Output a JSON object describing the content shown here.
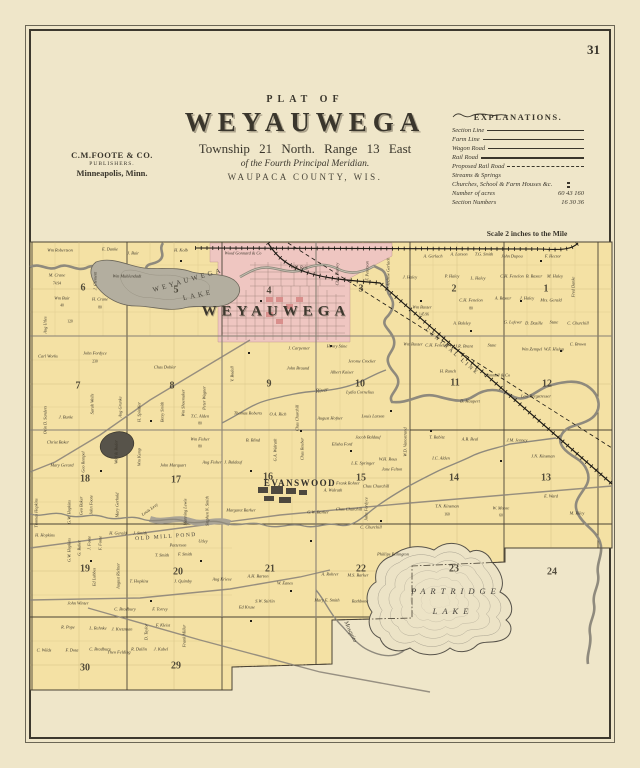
{
  "page": {
    "number": "31"
  },
  "publisher": {
    "line1": "C.M.FOOTE & CO.",
    "line2": "PUBLISHERS.",
    "line3": "Minneapolis, Minn."
  },
  "title": {
    "plat_of": "PLAT OF",
    "name": "WEYAUWEGA",
    "township": "Township  21  North.  Range  13  East",
    "meridian": "of the Fourth Principal Meridian.",
    "county": "WAUPACA COUNTY, WIS."
  },
  "legend": {
    "title": "EXPLANATIONS.",
    "rows": [
      {
        "label": "Section Line",
        "symbol": "solid-thin"
      },
      {
        "label": "Farm Line",
        "symbol": "solid-thin"
      },
      {
        "label": "Wagon Road",
        "symbol": "solid-medium"
      },
      {
        "label": "Rail Road",
        "symbol": "railroad"
      },
      {
        "label": "Proposed Rail Road",
        "symbol": "dashed"
      },
      {
        "label": "Streams & Springs",
        "symbol": "stream"
      },
      {
        "label": "Churches, School & Farm Houses &c.",
        "symbol": "dots"
      },
      {
        "label": "Number of acres",
        "symbol": "text",
        "value": "60  43  160"
      },
      {
        "label": "Section Numbers",
        "symbol": "text",
        "value": "16  30  36"
      }
    ]
  },
  "scale": {
    "text": "Scale 2 inches to the Mile"
  },
  "map": {
    "colors": {
      "parcel": "#f4e1a4",
      "village": "#efc6c1",
      "water": "#b3ae9f",
      "line": "#4a4335",
      "cream": "#efe6c9"
    },
    "place_labels": [
      {
        "t": "WEYAUWEGA",
        "x": 276,
        "y": 312,
        "cls": "village-name"
      },
      {
        "t": "WEYAUWEGA",
        "x": 188,
        "y": 280,
        "cls": "lake-name",
        "r": -16
      },
      {
        "t": "LAKE",
        "x": 198,
        "y": 295,
        "cls": "lake-name",
        "r": -12
      },
      {
        "t": "EVANSWOOD",
        "x": 300,
        "y": 483,
        "cls": "town-name"
      },
      {
        "t": "PARTRIDGE",
        "x": 456,
        "y": 591,
        "cls": "lake-name2"
      },
      {
        "t": "LAKE",
        "x": 453,
        "y": 611,
        "cls": "lake-name2"
      },
      {
        "t": "OLD MILL POND",
        "x": 166,
        "y": 537,
        "cls": "pond-name",
        "r": -4
      },
      {
        "t": "CENTRAL LINE",
        "x": 452,
        "y": 352,
        "cls": "rr-name",
        "r": 41
      },
      {
        "t": "Mosquito",
        "x": 350,
        "y": 632,
        "cls": "creek-name",
        "r": 65
      },
      {
        "t": "River",
        "x": 322,
        "y": 391,
        "cls": "creek-name",
        "r": -8
      }
    ],
    "section_numbers": [
      {
        "t": "1",
        "x": 546,
        "y": 289
      },
      {
        "t": "2",
        "x": 454,
        "y": 289
      },
      {
        "t": "3",
        "x": 361,
        "y": 289
      },
      {
        "t": "4",
        "x": 269,
        "y": 291
      },
      {
        "t": "5",
        "x": 176,
        "y": 290
      },
      {
        "t": "6",
        "x": 83,
        "y": 288
      },
      {
        "t": "7",
        "x": 78,
        "y": 386
      },
      {
        "t": "8",
        "x": 172,
        "y": 386
      },
      {
        "t": "9",
        "x": 269,
        "y": 384
      },
      {
        "t": "10",
        "x": 360,
        "y": 384
      },
      {
        "t": "11",
        "x": 455,
        "y": 383
      },
      {
        "t": "12",
        "x": 547,
        "y": 384
      },
      {
        "t": "13",
        "x": 546,
        "y": 478
      },
      {
        "t": "14",
        "x": 454,
        "y": 478
      },
      {
        "t": "15",
        "x": 361,
        "y": 478
      },
      {
        "t": "16",
        "x": 268,
        "y": 477
      },
      {
        "t": "17",
        "x": 176,
        "y": 480
      },
      {
        "t": "18",
        "x": 85,
        "y": 479
      },
      {
        "t": "19",
        "x": 85,
        "y": 569
      },
      {
        "t": "20",
        "x": 178,
        "y": 572
      },
      {
        "t": "21",
        "x": 270,
        "y": 569
      },
      {
        "t": "22",
        "x": 361,
        "y": 569
      },
      {
        "t": "23",
        "x": 454,
        "y": 569
      },
      {
        "t": "24",
        "x": 552,
        "y": 572
      },
      {
        "t": "29",
        "x": 176,
        "y": 666
      },
      {
        "t": "30",
        "x": 85,
        "y": 668
      }
    ],
    "owners": [
      {
        "t": "Wm Robertson",
        "x": 60,
        "y": 251
      },
      {
        "t": "M. Crane",
        "x": 57,
        "y": 276
      },
      {
        "t": "74.94",
        "x": 57,
        "y": 284,
        "cls": "acre",
        "s": 0.6
      },
      {
        "t": "Wm Bair",
        "x": 62,
        "y": 299
      },
      {
        "t": "40",
        "x": 62,
        "y": 306,
        "cls": "acre",
        "s": 0.6
      },
      {
        "t": "H. Crane",
        "x": 100,
        "y": 300
      },
      {
        "t": "80",
        "x": 100,
        "y": 308,
        "cls": "acre",
        "s": 0.6
      },
      {
        "t": "Aug Utles",
        "x": 46,
        "y": 325,
        "r": -90
      },
      {
        "t": "120",
        "x": 70,
        "y": 322,
        "cls": "acre",
        "s": 0.6
      },
      {
        "t": "John Fordyce",
        "x": 95,
        "y": 354
      },
      {
        "t": "230",
        "x": 95,
        "y": 362,
        "cls": "acre",
        "s": 0.6
      },
      {
        "t": "Carl Works",
        "x": 48,
        "y": 357
      },
      {
        "t": "J. Clement",
        "x": 96,
        "y": 281,
        "r": -90
      },
      {
        "t": "Wm Muhlendadt",
        "x": 127,
        "y": 277
      },
      {
        "t": "J. Bair",
        "x": 133,
        "y": 254
      },
      {
        "t": "H. Kolb",
        "x": 181,
        "y": 251
      },
      {
        "t": "E. Danke",
        "x": 110,
        "y": 250
      },
      {
        "t": "Wood Gonnard & Co",
        "x": 243,
        "y": 254
      },
      {
        "t": "W.H. Reis",
        "x": 299,
        "y": 268
      },
      {
        "t": "Chas Harvey",
        "x": 338,
        "y": 274,
        "r": -90
      },
      {
        "t": "F. Peterson",
        "x": 368,
        "y": 271,
        "r": -90
      },
      {
        "t": "Andrew Gerlach",
        "x": 389,
        "y": 272,
        "r": -90
      },
      {
        "t": "A. Gerlach",
        "x": 433,
        "y": 257
      },
      {
        "t": "A. Larson",
        "x": 459,
        "y": 255
      },
      {
        "t": "T.G. Smith",
        "x": 484,
        "y": 255
      },
      {
        "t": "John Dupou",
        "x": 512,
        "y": 257
      },
      {
        "t": "F. Hector",
        "x": 553,
        "y": 257
      },
      {
        "t": "Fred Danke",
        "x": 574,
        "y": 287,
        "r": -90
      },
      {
        "t": "J. Haley",
        "x": 410,
        "y": 278
      },
      {
        "t": "P. Haley",
        "x": 452,
        "y": 277
      },
      {
        "t": "L. Haley",
        "x": 478,
        "y": 279
      },
      {
        "t": "C.H. Fenelon",
        "x": 512,
        "y": 277
      },
      {
        "t": "B. Baxter",
        "x": 534,
        "y": 277
      },
      {
        "t": "M. Haley",
        "x": 555,
        "y": 277
      },
      {
        "t": "Wm Baxter",
        "x": 422,
        "y": 308
      },
      {
        "t": "145.96",
        "x": 424,
        "y": 315,
        "cls": "acre",
        "s": 0.6
      },
      {
        "t": "C.H. Fenelon",
        "x": 471,
        "y": 301
      },
      {
        "t": "80",
        "x": 471,
        "y": 309,
        "cls": "acre",
        "s": 0.6
      },
      {
        "t": "A. Baxter",
        "x": 503,
        "y": 299
      },
      {
        "t": "J. Haley",
        "x": 527,
        "y": 299
      },
      {
        "t": "Mrs. Gerald",
        "x": 551,
        "y": 301
      },
      {
        "t": "A. Balsley",
        "x": 462,
        "y": 324
      },
      {
        "t": "G. Lefever",
        "x": 513,
        "y": 323
      },
      {
        "t": "D. Dazille",
        "x": 534,
        "y": 324
      },
      {
        "t": "State",
        "x": 554,
        "y": 323
      },
      {
        "t": "C. Churchill",
        "x": 578,
        "y": 324
      },
      {
        "t": "Wm Baxter",
        "x": 413,
        "y": 345
      },
      {
        "t": "C.H. Fenelon",
        "x": 437,
        "y": 346
      },
      {
        "t": "J.R. Brant",
        "x": 464,
        "y": 347
      },
      {
        "t": "State",
        "x": 492,
        "y": 346
      },
      {
        "t": "Wm Zempel",
        "x": 532,
        "y": 350
      },
      {
        "t": "W.F. Hislop",
        "x": 554,
        "y": 350
      },
      {
        "t": "C. Brown",
        "x": 578,
        "y": 345
      },
      {
        "t": "Henry Stine",
        "x": 337,
        "y": 347
      },
      {
        "t": "J. Carpenter",
        "x": 299,
        "y": 349
      },
      {
        "t": "Jerome Crocker",
        "x": 362,
        "y": 362
      },
      {
        "t": "Albert Kaiser",
        "x": 342,
        "y": 373
      },
      {
        "t": "H. Ranch",
        "x": 448,
        "y": 372
      },
      {
        "t": "Gammell & Co",
        "x": 497,
        "y": 376
      },
      {
        "t": "Levi Bergstresser",
        "x": 536,
        "y": 397
      },
      {
        "t": "D. Haupert",
        "x": 470,
        "y": 402
      },
      {
        "t": "A.B. Beal",
        "x": 470,
        "y": 440
      },
      {
        "t": "J.M. Jenney",
        "x": 517,
        "y": 441
      },
      {
        "t": "T. Babitz",
        "x": 437,
        "y": 438
      },
      {
        "t": "I.C. Alden",
        "x": 441,
        "y": 459
      },
      {
        "t": "W.D. Vanostrand",
        "x": 406,
        "y": 442,
        "r": -90
      },
      {
        "t": "J.N. Kinsman",
        "x": 543,
        "y": 457
      },
      {
        "t": "M. Riley",
        "x": 577,
        "y": 514
      },
      {
        "t": "E. Ward",
        "x": 551,
        "y": 497
      },
      {
        "t": "W. Moore",
        "x": 501,
        "y": 509
      },
      {
        "t": "60",
        "x": 501,
        "y": 516,
        "cls": "acre",
        "s": 0.6
      },
      {
        "t": "Chas Dobler",
        "x": 165,
        "y": 368
      },
      {
        "t": "Orin D. Sanders",
        "x": 46,
        "y": 420,
        "r": -90
      },
      {
        "t": "Sarah Wells",
        "x": 93,
        "y": 404,
        "r": -90
      },
      {
        "t": "Aug Grunke",
        "x": 121,
        "y": 407,
        "r": -90
      },
      {
        "t": "H. Spindler",
        "x": 140,
        "y": 412,
        "r": -90
      },
      {
        "t": "Betsy Smith",
        "x": 163,
        "y": 412,
        "r": -90
      },
      {
        "t": "Wm Shoemaker",
        "x": 184,
        "y": 403,
        "r": -90
      },
      {
        "t": "Peter Wagner",
        "x": 205,
        "y": 398,
        "r": -90
      },
      {
        "t": "T.C. Alden",
        "x": 200,
        "y": 417
      },
      {
        "t": "80",
        "x": 200,
        "y": 424,
        "cls": "acre",
        "s": 0.6
      },
      {
        "t": "Wm Fisher",
        "x": 200,
        "y": 440
      },
      {
        "t": "80",
        "x": 200,
        "y": 447,
        "cls": "acre",
        "s": 0.6
      },
      {
        "t": "Christ Baker",
        "x": 58,
        "y": 443
      },
      {
        "t": "Mary Gerard",
        "x": 62,
        "y": 466
      },
      {
        "t": "J. Burke",
        "x": 66,
        "y": 418
      },
      {
        "t": "Geo Rempel",
        "x": 84,
        "y": 462,
        "r": -90
      },
      {
        "t": "Wolf & Bader",
        "x": 117,
        "y": 452,
        "r": -90
      },
      {
        "t": "Wm Kemp",
        "x": 140,
        "y": 457,
        "r": -90
      },
      {
        "t": "John Marquart",
        "x": 173,
        "y": 466
      },
      {
        "t": "Aug Fisher",
        "x": 212,
        "y": 463
      },
      {
        "t": "V. Bodell",
        "x": 233,
        "y": 374,
        "r": -90
      },
      {
        "t": "John Braund",
        "x": 298,
        "y": 369
      },
      {
        "t": "Thomas Roberts",
        "x": 248,
        "y": 414
      },
      {
        "t": "O.A. Rich",
        "x": 278,
        "y": 415
      },
      {
        "t": "Chas Churchill",
        "x": 298,
        "y": 418,
        "r": -90
      },
      {
        "t": "August Hofner",
        "x": 330,
        "y": 419
      },
      {
        "t": "Louis Larson",
        "x": 373,
        "y": 417
      },
      {
        "t": "Lydia Cornelius",
        "x": 360,
        "y": 393
      },
      {
        "t": "B. Blind",
        "x": 253,
        "y": 441
      },
      {
        "t": "J. Baldauf",
        "x": 233,
        "y": 463
      },
      {
        "t": "Elisha Ford",
        "x": 342,
        "y": 445
      },
      {
        "t": "Jacob Baldauf",
        "x": 368,
        "y": 438
      },
      {
        "t": "L.E. Springer",
        "x": 363,
        "y": 464
      },
      {
        "t": "W.H. Rous",
        "x": 388,
        "y": 460
      },
      {
        "t": "Jane Felton",
        "x": 392,
        "y": 470
      },
      {
        "t": "Frank Rohrer",
        "x": 348,
        "y": 484
      },
      {
        "t": "Chas Churchill",
        "x": 376,
        "y": 487
      },
      {
        "t": "G.W. Barker",
        "x": 318,
        "y": 513
      },
      {
        "t": "Chas Churchill",
        "x": 349,
        "y": 510
      },
      {
        "t": "John Fordyce",
        "x": 367,
        "y": 509,
        "r": -90
      },
      {
        "t": "C. Churchill",
        "x": 371,
        "y": 528
      },
      {
        "t": "Chas Reuber",
        "x": 303,
        "y": 449,
        "r": -90
      },
      {
        "t": "G.A. Walrath",
        "x": 276,
        "y": 450,
        "r": -90
      },
      {
        "t": "A. Walrath",
        "x": 333,
        "y": 491
      },
      {
        "t": "Margaret Barker",
        "x": 241,
        "y": 511
      },
      {
        "t": "T.N. Kinsman",
        "x": 447,
        "y": 507
      },
      {
        "t": "160",
        "x": 447,
        "y": 515,
        "cls": "acre",
        "s": 0.6
      },
      {
        "t": "Phillips Billington",
        "x": 393,
        "y": 555
      },
      {
        "t": "Thomas Hopkins",
        "x": 37,
        "y": 513,
        "r": -90
      },
      {
        "t": "G.W. Hopkins",
        "x": 70,
        "y": 512,
        "r": -90
      },
      {
        "t": "Geo Baker",
        "x": 82,
        "y": 506,
        "r": -90
      },
      {
        "t": "John Foote",
        "x": 92,
        "y": 505,
        "r": -90
      },
      {
        "t": "Mary Gerhold",
        "x": 118,
        "y": 505,
        "r": -90
      },
      {
        "t": "Louis Levy",
        "x": 150,
        "y": 510,
        "r": -35
      },
      {
        "t": "Manning Lewis",
        "x": 186,
        "y": 512,
        "r": -90
      },
      {
        "t": "Stephen N. Smith",
        "x": 208,
        "y": 511,
        "r": -90
      },
      {
        "t": "H. Hopkins",
        "x": 45,
        "y": 536
      },
      {
        "t": "G.W. Hopkins",
        "x": 70,
        "y": 550,
        "r": -90
      },
      {
        "t": "G. Baker",
        "x": 80,
        "y": 548,
        "r": -90
      },
      {
        "t": "J. Foote",
        "x": 90,
        "y": 543,
        "r": -90
      },
      {
        "t": "F. Foote",
        "x": 101,
        "y": 543,
        "r": -90
      },
      {
        "t": "H. Gerald",
        "x": 118,
        "y": 534
      },
      {
        "t": "J. Smith",
        "x": 140,
        "y": 534
      },
      {
        "t": "Patterson",
        "x": 178,
        "y": 546
      },
      {
        "t": "Utley",
        "x": 203,
        "y": 542
      },
      {
        "t": "T. Smith",
        "x": 162,
        "y": 556
      },
      {
        "t": "F. Smith",
        "x": 185,
        "y": 555
      },
      {
        "t": "Ed Lubbes",
        "x": 95,
        "y": 577,
        "r": -90
      },
      {
        "t": "August Richter",
        "x": 119,
        "y": 576,
        "r": -90
      },
      {
        "t": "T. Hopkins",
        "x": 139,
        "y": 582
      },
      {
        "t": "J. Quimby",
        "x": 183,
        "y": 582
      },
      {
        "t": "John Winter",
        "x": 78,
        "y": 604
      },
      {
        "t": "C. Bradbury",
        "x": 125,
        "y": 610
      },
      {
        "t": "F. Torrey",
        "x": 160,
        "y": 610
      },
      {
        "t": "R. Pope",
        "x": 68,
        "y": 628
      },
      {
        "t": "L. Rehnke",
        "x": 98,
        "y": 629
      },
      {
        "t": "J. Kretzman",
        "x": 122,
        "y": 630
      },
      {
        "t": "D. Taylor",
        "x": 147,
        "y": 632,
        "r": -90
      },
      {
        "t": "F. Kleist",
        "x": 163,
        "y": 626
      },
      {
        "t": "Frank Miller",
        "x": 185,
        "y": 636,
        "r": -90
      },
      {
        "t": "C. Wilds",
        "x": 44,
        "y": 651
      },
      {
        "t": "F. Dota",
        "x": 72,
        "y": 651
      },
      {
        "t": "C. Bradbury",
        "x": 100,
        "y": 650
      },
      {
        "t": "Theo Felding",
        "x": 119,
        "y": 653
      },
      {
        "t": "R. Dallin",
        "x": 139,
        "y": 650
      },
      {
        "t": "J. Kabel",
        "x": 161,
        "y": 650
      },
      {
        "t": "Aug Kriese",
        "x": 222,
        "y": 580
      },
      {
        "t": "A.H. Barton",
        "x": 258,
        "y": 577
      },
      {
        "t": "W. Eanes",
        "x": 285,
        "y": 584
      },
      {
        "t": "S.W. Stirlin",
        "x": 265,
        "y": 602
      },
      {
        "t": "Ed Kruse",
        "x": 247,
        "y": 608
      },
      {
        "t": "A. Rohrer",
        "x": 330,
        "y": 575
      },
      {
        "t": "M.S. Barker",
        "x": 358,
        "y": 576
      },
      {
        "t": "Mary E. Smith",
        "x": 327,
        "y": 601
      },
      {
        "t": "Rathbone",
        "x": 360,
        "y": 602
      }
    ]
  }
}
